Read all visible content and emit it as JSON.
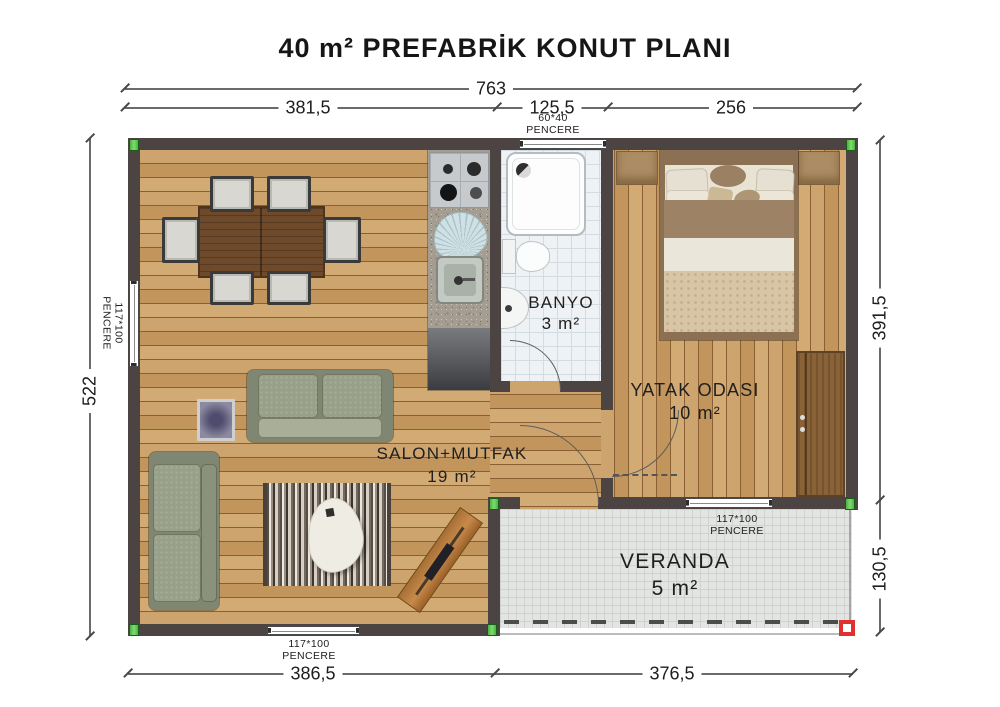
{
  "title": "40 m² PREFABRİK KONUT PLANI",
  "dimensions": {
    "top_total": "763",
    "top_segments": [
      "381,5",
      "125,5",
      "256"
    ],
    "left_total": "522",
    "right_upper": "391,5",
    "right_lower": "130,5",
    "bottom_left": "386,5",
    "bottom_right": "376,5"
  },
  "window_labels": {
    "top": {
      "size": "60*40",
      "word": "PENCERE"
    },
    "left": {
      "size": "117*100",
      "word": "PENCERE"
    },
    "veranda": {
      "size": "117*100",
      "word": "PENCERE"
    },
    "bottom": {
      "size": "117*100",
      "word": "PENCERE"
    }
  },
  "rooms": {
    "banyo": {
      "name": "BANYO",
      "area": "3 m²"
    },
    "yatak": {
      "name": "YATAK ODASI",
      "area": "10 m²"
    },
    "salon": {
      "name": "SALON+MUTFAK",
      "area": "19 m²"
    },
    "veranda": {
      "name": "VERANDA",
      "area": "5 m²"
    }
  },
  "colors": {
    "wall": "#4b4442",
    "wood_floor": "#c79e66",
    "bathroom_tile": "#eff2f5",
    "veranda_tile": "#e3e5e2",
    "marker_green": "#49b23f",
    "marker_red": "#e03131"
  }
}
